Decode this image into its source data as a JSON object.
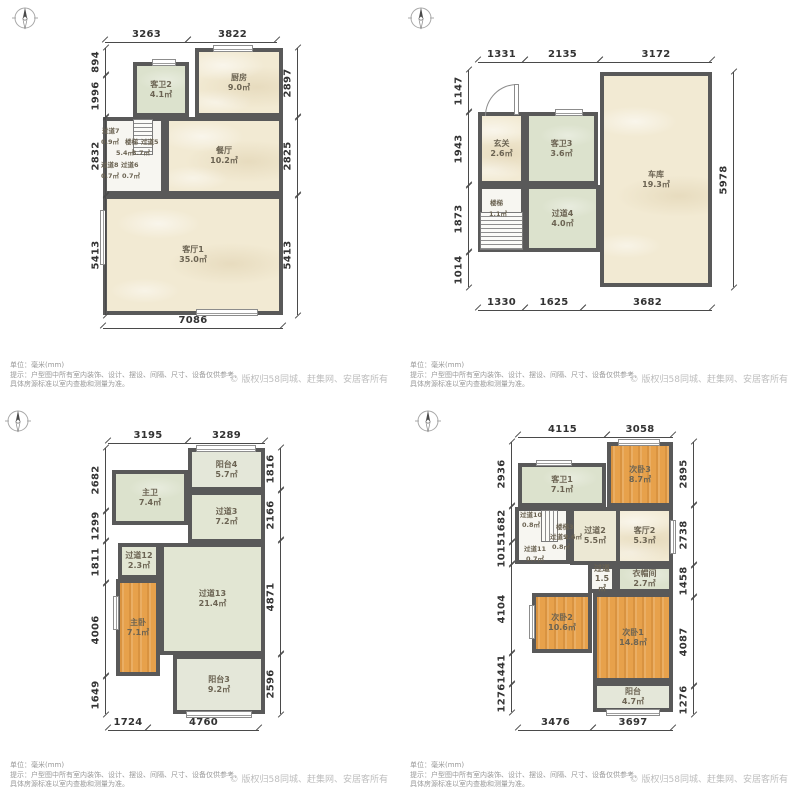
{
  "footer": {
    "unit": "单位：毫米(mm)",
    "hint1": "提示：户型图中所有室内装饰、设计、摆设、间隔、尺寸、设备仅供参考，",
    "hint2": "具体房源标准以室内查勘和测量为准。",
    "copyright": "© 版权归58同城、赶集网、安居客所有"
  },
  "colors": {
    "wall": "#595959",
    "bedroom_fill": "#e7a14b",
    "bath_fill": "#dce2cd",
    "living_fill": "#f2ead3",
    "hallway_fill": "#e2e6d3",
    "balcony_fill": "#e4e7d9"
  },
  "plans": [
    {
      "id": "floor-1",
      "origin": {
        "x": 0,
        "y": 0
      },
      "compass": {
        "x": 12,
        "y": 5
      },
      "rooms": [
        {
          "name": "厨房",
          "area": "9.0㎡",
          "x": 195,
          "y": 48,
          "w": 88,
          "h": 69,
          "fill": "marble"
        },
        {
          "name": "客卫2",
          "area": "4.1㎡",
          "x": 133,
          "y": 62,
          "w": 56,
          "h": 55,
          "fill": "green"
        },
        {
          "name": "餐厅",
          "area": "10.2㎡",
          "x": 165,
          "y": 117,
          "w": 118,
          "h": 78,
          "fill": "marble"
        },
        {
          "name": "",
          "area": "",
          "x": 103,
          "y": 117,
          "w": 62,
          "h": 78,
          "fill": "white"
        },
        {
          "name": "客厅1",
          "area": "35.0㎡",
          "x": 103,
          "y": 195,
          "w": 180,
          "h": 120,
          "fill": "marble"
        }
      ],
      "stairs": [
        {
          "x": 133,
          "y": 119,
          "w": 20,
          "h": 36,
          "dir": "h"
        }
      ],
      "labels": [
        {
          "t": "过道7",
          "x": 102,
          "y": 128
        },
        {
          "t": "0.9㎡",
          "x": 101,
          "y": 139
        },
        {
          "t": "楼梯",
          "x": 125,
          "y": 139
        },
        {
          "t": "过道5",
          "x": 141,
          "y": 139
        },
        {
          "t": "5.4㎡",
          "x": 116,
          "y": 150
        },
        {
          "t": "3.7㎡",
          "x": 132,
          "y": 150
        },
        {
          "t": "过道8",
          "x": 101,
          "y": 162
        },
        {
          "t": "过道6",
          "x": 121,
          "y": 162
        },
        {
          "t": "0.7㎡",
          "x": 101,
          "y": 173
        },
        {
          "t": "0.7㎡",
          "x": 122,
          "y": 173
        }
      ],
      "windows": [
        {
          "x": 152,
          "y": 59,
          "w": 24,
          "h": 7,
          "o": "h"
        },
        {
          "x": 213,
          "y": 45,
          "w": 40,
          "h": 7,
          "o": "h"
        },
        {
          "x": 100,
          "y": 210,
          "w": 6,
          "h": 55,
          "o": "v"
        },
        {
          "x": 196,
          "y": 309,
          "w": 62,
          "h": 7,
          "o": "h"
        }
      ],
      "doors": [],
      "dims": {
        "top": {
          "y": 42,
          "segs": [
            {
              "v": "3263",
              "a": 105,
              "b": 188
            },
            {
              "v": "3822",
              "a": 188,
              "b": 277
            }
          ]
        },
        "bottom": {
          "y": 328,
          "segs": [
            {
              "v": "7086",
              "a": 103,
              "b": 283
            }
          ]
        },
        "left": {
          "x": 105,
          "segs": [
            {
              "v": "894",
              "a": 48,
              "b": 75
            },
            {
              "v": "1996",
              "a": 75,
              "b": 117
            },
            {
              "v": "2832",
              "a": 117,
              "b": 195
            },
            {
              "v": "5413",
              "a": 195,
              "b": 315
            }
          ]
        },
        "right": {
          "x": 297,
          "segs": [
            {
              "v": "2897",
              "a": 48,
              "b": 117
            },
            {
              "v": "2825",
              "a": 117,
              "b": 195
            },
            {
              "v": "5413",
              "a": 195,
              "b": 315
            }
          ]
        }
      }
    },
    {
      "id": "floor-2",
      "origin": {
        "x": 400,
        "y": 0
      },
      "compass": {
        "x": 8,
        "y": 5
      },
      "rooms": [
        {
          "name": "玄关",
          "area": "2.6㎡",
          "x": 78,
          "y": 112,
          "w": 47,
          "h": 73,
          "fill": "marble"
        },
        {
          "name": "客卫3",
          "area": "3.6㎡",
          "x": 125,
          "y": 112,
          "w": 73,
          "h": 73,
          "fill": "green"
        },
        {
          "name": "车库",
          "area": "19.3㎡",
          "x": 200,
          "y": 72,
          "w": 112,
          "h": 215,
          "fill": "marble"
        },
        {
          "name": "",
          "area": "",
          "x": 78,
          "y": 185,
          "w": 47,
          "h": 67,
          "fill": "white"
        },
        {
          "name": "过道4",
          "area": "4.0㎡",
          "x": 125,
          "y": 185,
          "w": 75,
          "h": 67,
          "fill": "green"
        }
      ],
      "stairs": [
        {
          "x": 80,
          "y": 212,
          "w": 43,
          "h": 38,
          "dir": "h"
        }
      ],
      "labels": [
        {
          "t": "楼梯",
          "x": 90,
          "y": 200
        },
        {
          "t": "1.1㎡",
          "x": 89,
          "y": 211
        }
      ],
      "windows": [
        {
          "x": 155,
          "y": 109,
          "w": 28,
          "h": 7,
          "o": "h"
        }
      ],
      "doors": [
        {
          "x": 85,
          "y": 84,
          "w": 31,
          "h": 31,
          "leaf": {
            "x": 114,
            "y": 84,
            "w": 5,
            "h": 31
          }
        }
      ],
      "dims": {
        "top": {
          "y": 62,
          "segs": [
            {
              "v": "1331",
              "a": 78,
              "b": 125
            },
            {
              "v": "2135",
              "a": 125,
              "b": 200
            },
            {
              "v": "3172",
              "a": 200,
              "b": 312
            }
          ]
        },
        "bottom": {
          "y": 310,
          "segs": [
            {
              "v": "1330",
              "a": 78,
              "b": 125
            },
            {
              "v": "1625",
              "a": 125,
              "b": 183
            },
            {
              "v": "3682",
              "a": 183,
              "b": 312
            }
          ]
        },
        "left": {
          "x": 68,
          "segs": [
            {
              "v": "1147",
              "a": 70,
              "b": 112
            },
            {
              "v": "1943",
              "a": 112,
              "b": 185
            },
            {
              "v": "1873",
              "a": 185,
              "b": 252
            },
            {
              "v": "1014",
              "a": 252,
              "b": 287
            }
          ]
        },
        "right": {
          "x": 333,
          "segs": [
            {
              "v": "5978",
              "a": 72,
              "b": 287
            }
          ]
        }
      }
    },
    {
      "id": "floor-3",
      "origin": {
        "x": 0,
        "y": 400
      },
      "compass": {
        "x": 5,
        "y": 8
      },
      "rooms": [
        {
          "name": "阳台4",
          "area": "5.7㎡",
          "x": 188,
          "y": 48,
          "w": 77,
          "h": 43,
          "fill": "balcony"
        },
        {
          "name": "主卫",
          "area": "7.4㎡",
          "x": 112,
          "y": 70,
          "w": 76,
          "h": 55,
          "fill": "green"
        },
        {
          "name": "过道3",
          "area": "7.2㎡",
          "x": 188,
          "y": 91,
          "w": 77,
          "h": 52,
          "fill": "sage"
        },
        {
          "name": "过道12",
          "area": "2.3㎡",
          "x": 118,
          "y": 143,
          "w": 42,
          "h": 36,
          "fill": "sage"
        },
        {
          "name": "过道13",
          "area": "21.4㎡",
          "x": 160,
          "y": 143,
          "w": 105,
          "h": 112,
          "fill": "sage"
        },
        {
          "name": "主卧",
          "area": "7.1㎡",
          "x": 116,
          "y": 179,
          "w": 44,
          "h": 97,
          "fill": "orange"
        },
        {
          "name": "阳台3",
          "area": "9.2㎡",
          "x": 173,
          "y": 255,
          "w": 92,
          "h": 59,
          "fill": "balcony"
        }
      ],
      "stairs": [],
      "labels": [],
      "windows": [
        {
          "x": 196,
          "y": 45,
          "w": 60,
          "h": 7,
          "o": "h"
        },
        {
          "x": 186,
          "y": 311,
          "w": 66,
          "h": 7,
          "o": "h"
        },
        {
          "x": 113,
          "y": 196,
          "w": 6,
          "h": 34,
          "o": "v"
        }
      ],
      "doors": [],
      "dims": {
        "top": {
          "y": 43,
          "segs": [
            {
              "v": "3195",
              "a": 108,
              "b": 188
            },
            {
              "v": "3289",
              "a": 188,
              "b": 265
            }
          ]
        },
        "bottom": {
          "y": 330,
          "segs": [
            {
              "v": "1724",
              "a": 108,
              "b": 148
            },
            {
              "v": "4760",
              "a": 148,
              "b": 259
            }
          ]
        },
        "left": {
          "x": 105,
          "segs": [
            {
              "v": "2682",
              "a": 48,
              "b": 111
            },
            {
              "v": "1299",
              "a": 111,
              "b": 141
            },
            {
              "v": "1811",
              "a": 141,
              "b": 183
            },
            {
              "v": "4006",
              "a": 183,
              "b": 276
            },
            {
              "v": "1649",
              "a": 276,
              "b": 314
            }
          ]
        },
        "right": {
          "x": 280,
          "segs": [
            {
              "v": "1816",
              "a": 48,
              "b": 90
            },
            {
              "v": "2166",
              "a": 90,
              "b": 140
            },
            {
              "v": "4871",
              "a": 140,
              "b": 254
            },
            {
              "v": "2596",
              "a": 254,
              "b": 314
            }
          ]
        }
      }
    },
    {
      "id": "floor-4",
      "origin": {
        "x": 400,
        "y": 400
      },
      "compass": {
        "x": 15,
        "y": 8
      },
      "rooms": [
        {
          "name": "客卫1",
          "area": "7.1㎡",
          "x": 118,
          "y": 63,
          "w": 88,
          "h": 44,
          "fill": "green"
        },
        {
          "name": "次卧3",
          "area": "8.7㎡",
          "x": 207,
          "y": 42,
          "w": 66,
          "h": 65,
          "fill": "orange"
        },
        {
          "name": "",
          "area": "",
          "x": 115,
          "y": 107,
          "w": 55,
          "h": 57,
          "fill": "white"
        },
        {
          "name": "过道2",
          "area": "5.5㎡",
          "x": 170,
          "y": 107,
          "w": 50,
          "h": 58,
          "fill": "cream"
        },
        {
          "name": "客厅2",
          "area": "5.3㎡",
          "x": 216,
          "y": 107,
          "w": 57,
          "h": 58,
          "fill": "marble"
        },
        {
          "name": "过道",
          "area": "1.5㎡",
          "x": 188,
          "y": 165,
          "w": 28,
          "h": 28,
          "fill": "white"
        },
        {
          "name": "衣帽间",
          "area": "2.7㎡",
          "x": 216,
          "y": 165,
          "w": 57,
          "h": 28,
          "fill": "green"
        },
        {
          "name": "次卧2",
          "area": "10.6㎡",
          "x": 132,
          "y": 193,
          "w": 60,
          "h": 60,
          "fill": "orange"
        },
        {
          "name": "次卧1",
          "area": "14.8㎡",
          "x": 193,
          "y": 193,
          "w": 80,
          "h": 89,
          "fill": "orange"
        },
        {
          "name": "阳台",
          "area": "4.7㎡",
          "x": 193,
          "y": 282,
          "w": 80,
          "h": 30,
          "fill": "balcony"
        }
      ],
      "stairs": [
        {
          "x": 141,
          "y": 110,
          "w": 17,
          "h": 32,
          "dir": "v"
        }
      ],
      "labels": [
        {
          "t": "过道10",
          "x": 120,
          "y": 112
        },
        {
          "t": "0.8㎡",
          "x": 122,
          "y": 122
        },
        {
          "t": "楼梯3",
          "x": 156,
          "y": 124
        },
        {
          "t": "过道9",
          "x": 150,
          "y": 134
        },
        {
          "t": "2.6㎡",
          "x": 164,
          "y": 134
        },
        {
          "t": "0.8㎡",
          "x": 152,
          "y": 144
        },
        {
          "t": "过道11",
          "x": 124,
          "y": 146
        },
        {
          "t": "0.7㎡",
          "x": 126,
          "y": 156
        }
      ],
      "windows": [
        {
          "x": 218,
          "y": 39,
          "w": 42,
          "h": 7,
          "o": "h"
        },
        {
          "x": 136,
          "y": 60,
          "w": 36,
          "h": 6,
          "o": "h"
        },
        {
          "x": 270,
          "y": 120,
          "w": 6,
          "h": 34,
          "o": "v"
        },
        {
          "x": 129,
          "y": 205,
          "w": 6,
          "h": 34,
          "o": "v"
        },
        {
          "x": 206,
          "y": 309,
          "w": 54,
          "h": 7,
          "o": "h"
        }
      ],
      "doors": [],
      "dims": {
        "top": {
          "y": 37,
          "segs": [
            {
              "v": "4115",
              "a": 118,
              "b": 207
            },
            {
              "v": "3058",
              "a": 207,
              "b": 273
            }
          ]
        },
        "bottom": {
          "y": 330,
          "segs": [
            {
              "v": "3476",
              "a": 118,
              "b": 193
            },
            {
              "v": "3697",
              "a": 193,
              "b": 273
            }
          ]
        },
        "left": {
          "x": 111,
          "segs": [
            {
              "v": "2936",
              "a": 42,
              "b": 106
            },
            {
              "v": "1682",
              "a": 106,
              "b": 142
            },
            {
              "v": "1015",
              "a": 142,
              "b": 164
            },
            {
              "v": "4104",
              "a": 164,
              "b": 253
            },
            {
              "v": "1441",
              "a": 253,
              "b": 284
            },
            {
              "v": "1276",
              "a": 284,
              "b": 312
            }
          ]
        },
        "right": {
          "x": 293,
          "segs": [
            {
              "v": "2895",
              "a": 42,
              "b": 105
            },
            {
              "v": "2738",
              "a": 105,
              "b": 165
            },
            {
              "v": "1458",
              "a": 165,
              "b": 197
            },
            {
              "v": "4087",
              "a": 197,
              "b": 286
            },
            {
              "v": "1276",
              "a": 286,
              "b": 314
            }
          ]
        }
      }
    }
  ]
}
